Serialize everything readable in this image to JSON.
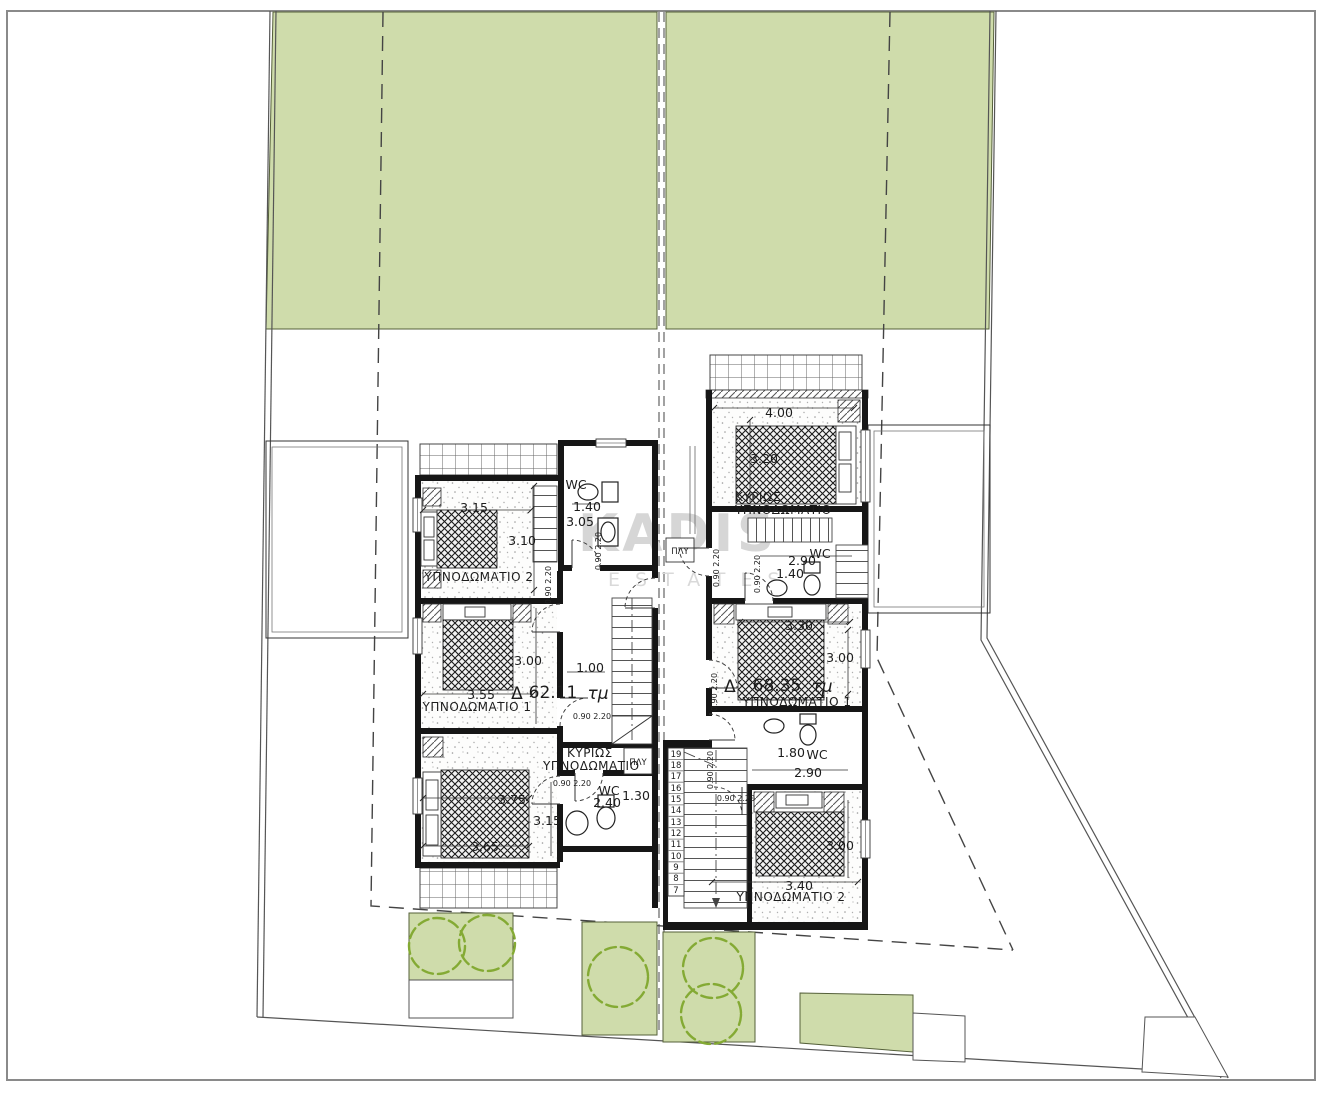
{
  "watermark": {
    "brand": "KADIS",
    "suffix": "ESTATES"
  },
  "labels": {
    "door": "0.90 2.20",
    "wc": "WC",
    "laundry": "ΠΛΥ"
  },
  "unit_a": {
    "area_delta": "Δ",
    "area_value": "62.11",
    "area_unit": "τμ",
    "bedroom1": "ΥΠΝΟΔΩΜΑΤΙΟ 1",
    "bedroom2": "ΥΠΝΟΔΩΜΑΤΙΟ 2",
    "master_line1": "ΚΥΡΙΩΣ",
    "master_line2": "ΥΠΝΟΔΩΜΑΤΙΟ",
    "dims": {
      "wc_w": "1.40",
      "wc_h": "3.05",
      "bed2_w": "3.15",
      "bed2_h": "3.10",
      "bed1_h": "3.00",
      "hall_w": "1.00",
      "bed1_w": "3.55",
      "master_w": "3.75",
      "master_h": "3.15",
      "master_w2": "3.65",
      "wc2_w": "2.40",
      "wc2_d": "1.30"
    }
  },
  "unit_b": {
    "area_delta": "Δ",
    "area_value": "68.35",
    "area_unit": "τμ",
    "bedroom1": "ΥΠΝΟΔΩΜΑΤΙΟ 1",
    "bedroom2": "ΥΠΝΟΔΩΜΑΤΙΟ 2",
    "master_line1": "ΚΥΡΙΩΣ",
    "master_line2": "ΥΠΝΟΔΩΜΑΤΙΟ",
    "dims": {
      "master_w": "4.00",
      "master_h": "3.20",
      "wc_w": "2.90",
      "wc_d": "1.40",
      "bed1_w": "3.30",
      "bed1_h": "3.00",
      "wc2_d": "1.80",
      "wc2_w": "2.90",
      "bed2_h": "3.00",
      "bed2_w": "3.40"
    }
  },
  "stairs": {
    "numbers": [
      "19",
      "18",
      "17",
      "16",
      "15",
      "14",
      "13",
      "12",
      "11",
      "10",
      "9",
      "8",
      "7"
    ]
  },
  "colors": {
    "green": "#cfdcab",
    "tree": "#84aa34"
  }
}
